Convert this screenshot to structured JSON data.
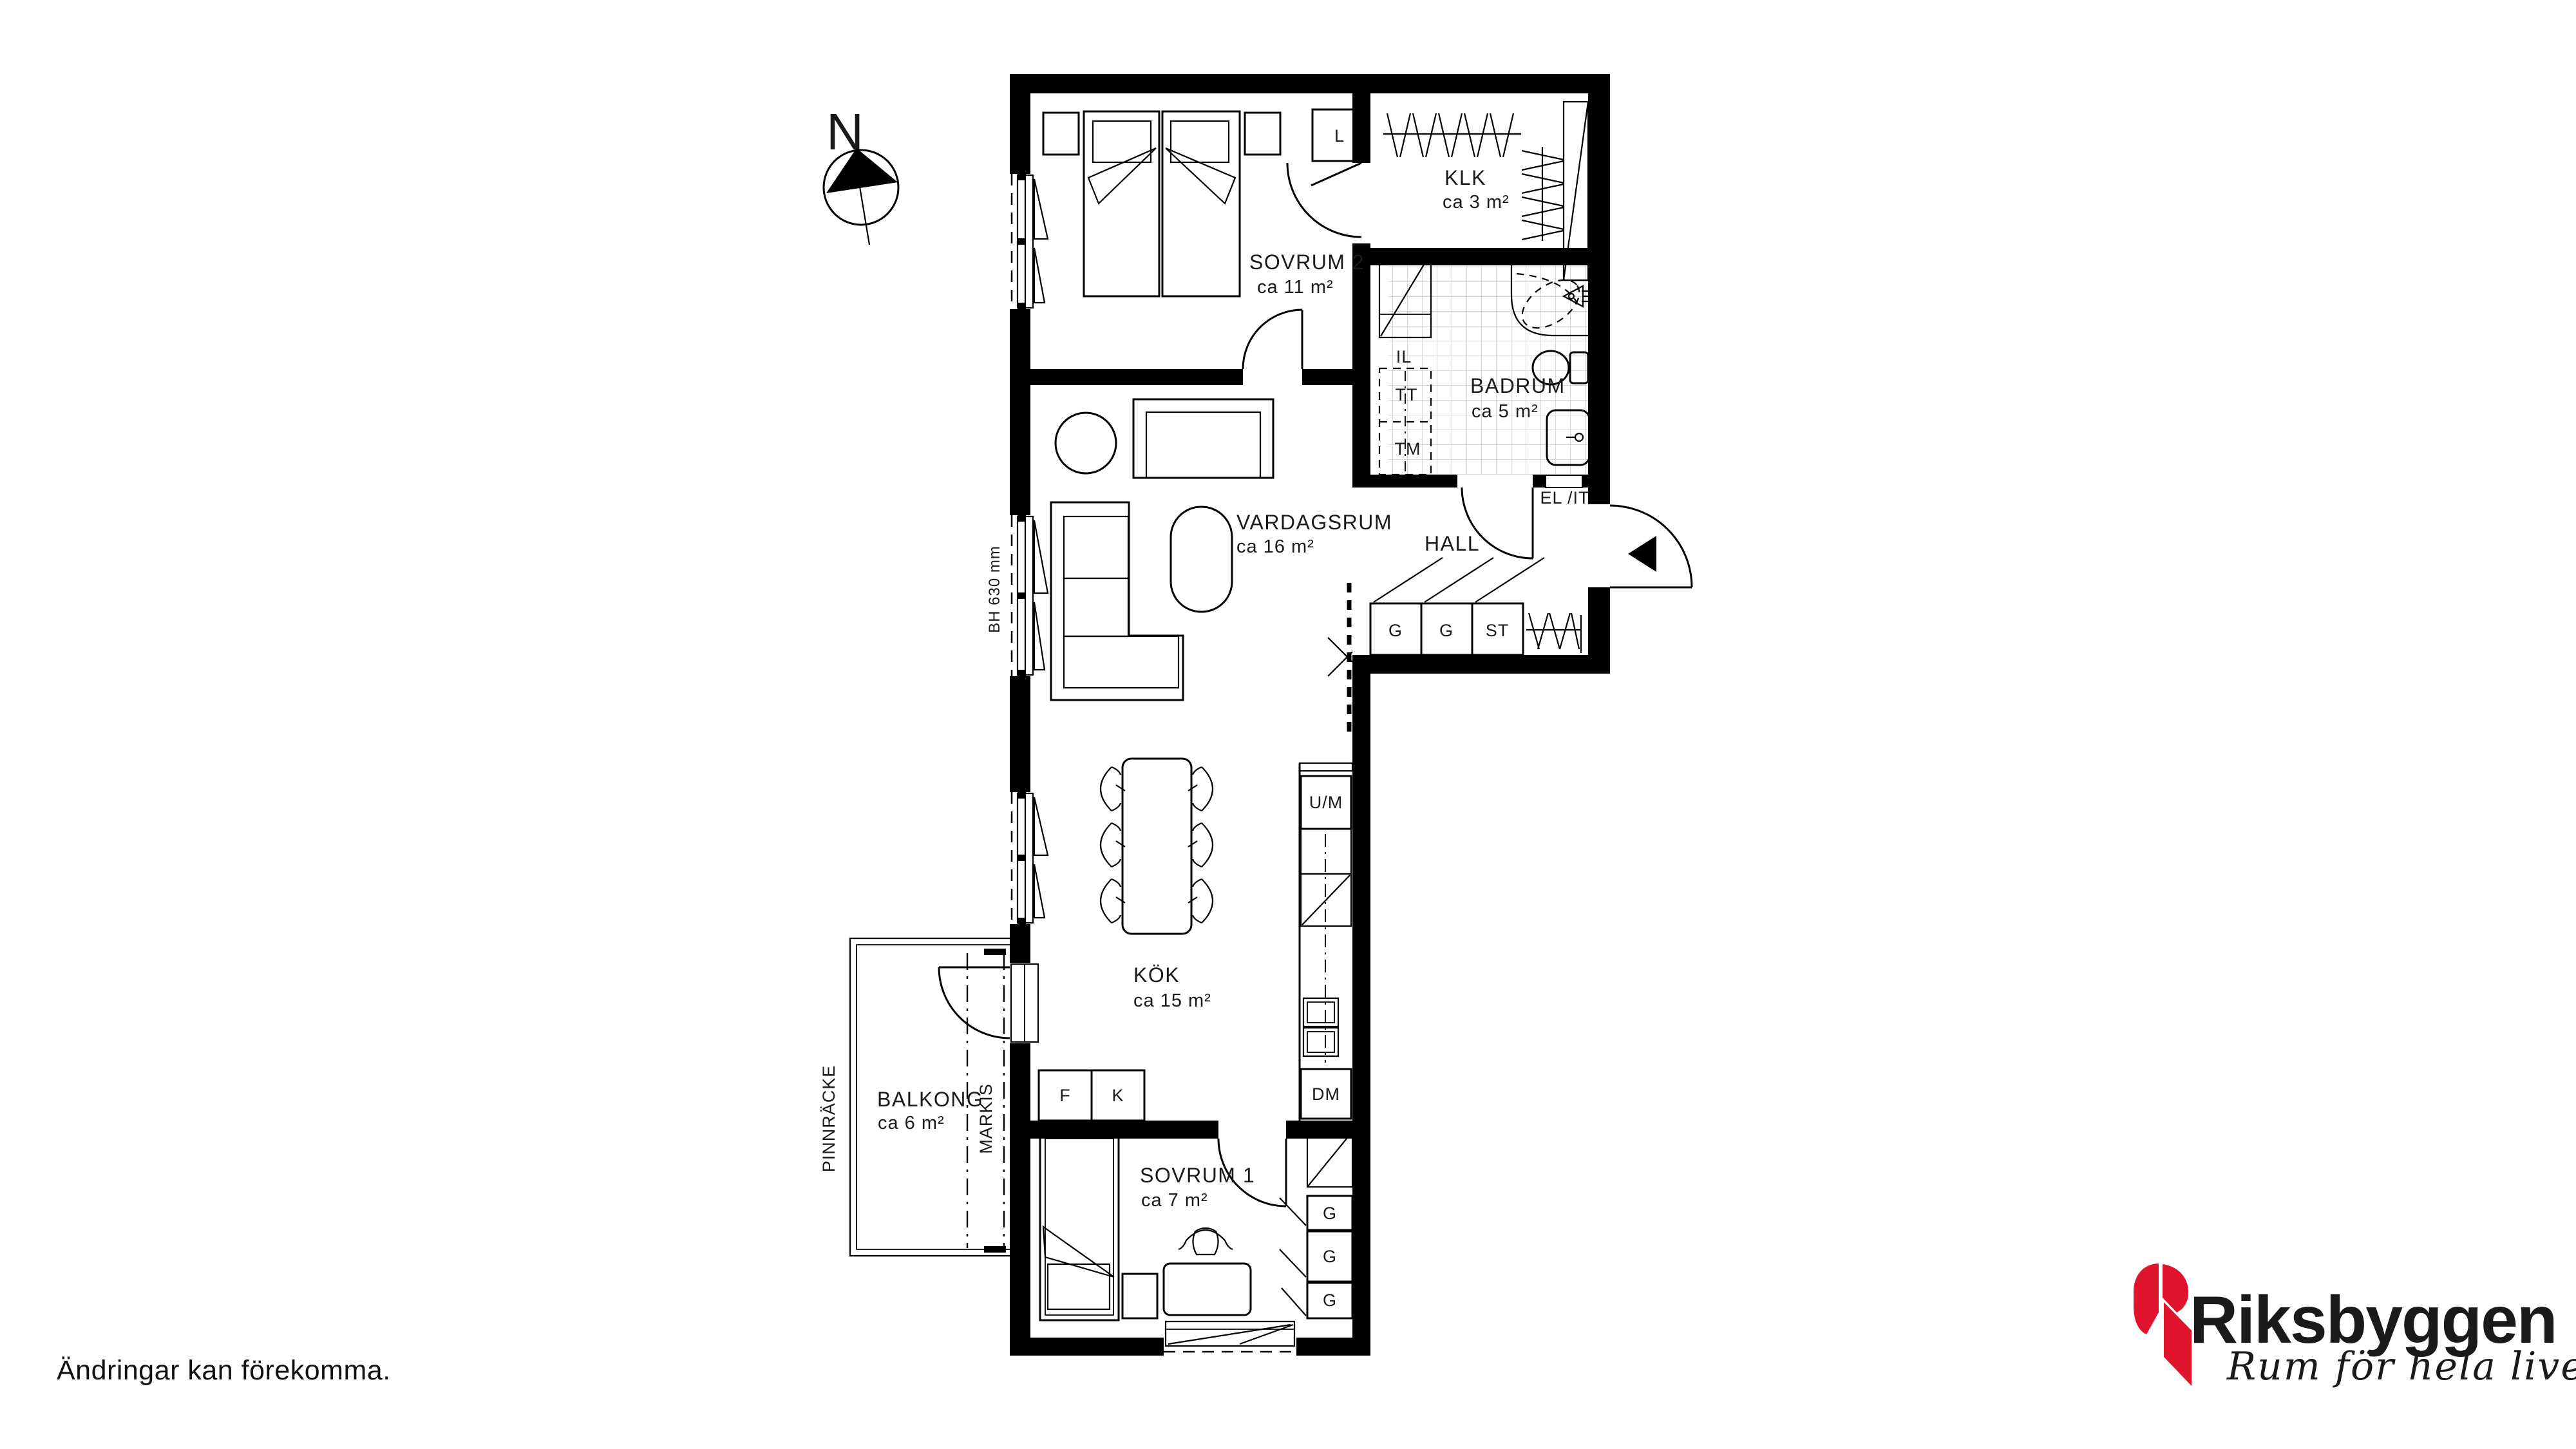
{
  "rooms": {
    "sovrum2": {
      "name": "SOVRUM 2",
      "area": "ca 11 m²"
    },
    "klk": {
      "name": "KLK",
      "area": "ca 3 m²"
    },
    "badrum": {
      "name": "BADRUM",
      "area": "ca 5 m²"
    },
    "hall": {
      "name": "HALL"
    },
    "vardagsrum": {
      "name": "VARDAGSRUM",
      "area": "ca 16 m²"
    },
    "kok": {
      "name": "KÖK",
      "area": "ca 15 m²"
    },
    "sovrum1": {
      "name": "SOVRUM 1",
      "area": "ca 7 m²"
    },
    "balkong": {
      "name": "BALKONG",
      "area": "ca 6 m²"
    }
  },
  "fixtures": {
    "linen_cabinet": "L",
    "bathroom_shelf": "IL",
    "dryer": "TT",
    "washer": "TM",
    "el_it": "EL /IT",
    "hall_wardrobe_1": "G",
    "hall_wardrobe_2": "G",
    "hall_cleaning": "ST",
    "oven_micro": "U/M",
    "dishwasher": "DM",
    "freezer": "F",
    "fridge": "K",
    "bedroom_wardrobe_1": "G",
    "bedroom_wardrobe_2": "G",
    "bedroom_wardrobe_3": "G"
  },
  "annotations": {
    "north": "N",
    "window_sill_height": "BH 630 mm",
    "railing": "PINNRÄCKE",
    "awning": "MARKIS",
    "disclaimer": "Ändringar kan förekomma."
  },
  "logo": {
    "brand": "Riksbyggen",
    "tagline": "Rum för hela livet",
    "brand_color": "#9d9d9c",
    "mark_color": "#e0142d",
    "tagline_color": "#141414"
  },
  "colors": {
    "wall": "#000000",
    "tile_line": "#cccccc",
    "background": "#ffffff"
  }
}
